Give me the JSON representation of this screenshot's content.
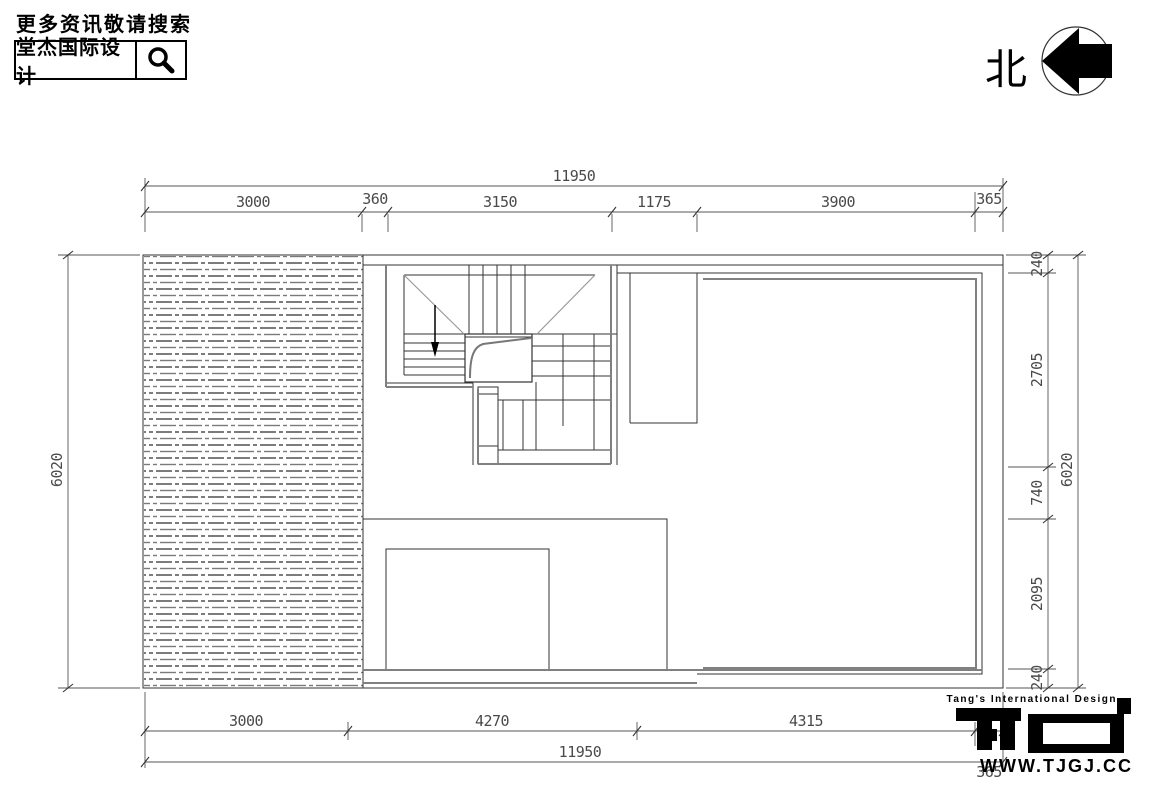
{
  "header": {
    "more_info": "更多资讯敬请搜索",
    "brand": "堂杰国际设计"
  },
  "compass": {
    "label": "北"
  },
  "dimensions": {
    "top_total": "11950",
    "top": [
      "3000",
      "360",
      "3150",
      "1175",
      "3900",
      "365"
    ],
    "left_total": "6020",
    "right": [
      "240",
      "2705",
      "740",
      "2095",
      "240"
    ],
    "right_total": "6020",
    "bottom": [
      "3000",
      "4270",
      "4315",
      "365"
    ],
    "bottom_total": "11950"
  },
  "logo": {
    "tagline": "Tang's International Design",
    "site": "WWW.TJGJ.CC"
  }
}
